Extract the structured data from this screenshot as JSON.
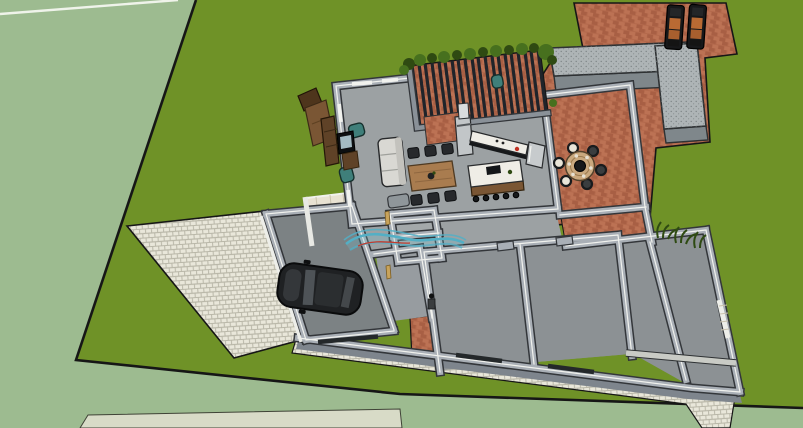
{
  "meta": {
    "view": "3d-architectural-model-top-perspective",
    "style": "sketchup-like-shaded-render",
    "canvas_width": 803,
    "canvas_height": 428,
    "visible_text": []
  },
  "palette": {
    "ground": "#9DBB90",
    "lawn": "#6F9227",
    "outline": "#161616",
    "paver": "#E9E7DA",
    "paver_joint": "#B9B7A8",
    "brick": "#B3694C",
    "brick_alt": "#A85F44",
    "brick_light": "#BC7254",
    "brick_joint": "#8F5038",
    "wall": "#A9AFB6",
    "wall_edge": "#33363A",
    "wall_hi": "#F1F2EE",
    "wall_face": "#7E858D",
    "floor": "#9CA1A3",
    "floor_bed": "#8C9194",
    "floor_garage": "#7C8284",
    "slat": "#20242A",
    "beam": "#8A9198",
    "plant": "#47701E",
    "plant_dark": "#2F4A12",
    "tuft": "#2E4A12",
    "bench_top": "#AEB4B6",
    "bench_side": "#7F878B",
    "lounger": "#17181A",
    "cushion": "#B96A33",
    "car": "#1F2123",
    "car_roof": "#2B2E30",
    "car_glass": "#4E5357",
    "sofa": "#D9D8D3",
    "teal": "#3F7F7A",
    "wood": "#A97C4F",
    "wood_dark": "#4F3A22",
    "brown": "#7A5634",
    "brown_dark": "#4E351C",
    "shelf": "#5F4227",
    "white_top": "#EFEDE6",
    "black": "#17191B",
    "steel": "#C7CBCD",
    "chimney": "#C2C6C8",
    "red": "#C03022",
    "table_tan": "#C9A87E",
    "seat_cream": "#E9E5D8",
    "tile": "#E8E2D2",
    "tile_line": "#C9C2AE",
    "door_tan": "#C8A35B",
    "swoosh": "#53AFC5",
    "swoosh_red": "#C23B2E",
    "glass": "#BFD9E3",
    "strip": "#D8DBC7",
    "counter_lt": "#C9CBC5",
    "window_dark": "#24282A",
    "white": "#EDEEE9"
  },
  "scene": {
    "site": {
      "label": "lawn-parcel-with-house",
      "surfaces": [
        "surrounding-ground",
        "lawn",
        "paver-driveway",
        "paver-walkway",
        "brick-patio"
      ]
    },
    "pergola": {
      "label": "louvered-pergola-over-outdoor-kitchen",
      "slat_count": 20,
      "planter_hedge": true
    },
    "outdoor": {
      "sun_loungers": 2,
      "round_table_chairs": 6,
      "l_shaped_bench": 1,
      "grass_tufts": 3
    },
    "living_area": {
      "sofa_gray": 1,
      "sofa_brown": 1,
      "teal_armchairs": 3,
      "coffee_table": 1,
      "tv_wall_unit": 1,
      "dining_table_chairs": 6,
      "kitchen_island_stools": 5,
      "counter_appliances": [
        "range-with-red-knob",
        "fridge",
        "chimney-oven"
      ]
    },
    "garage": {
      "car": "dark-suv-top-view",
      "door_side": "driveway-left"
    },
    "rooms": {
      "bedrooms": 2,
      "right_wing_rooms": 3,
      "small_service_rooms": 2,
      "entry_porch": 1
    },
    "annotation": {
      "label": "teal-curved-swoosh-with-red-accent",
      "location": "hallway-center"
    }
  }
}
